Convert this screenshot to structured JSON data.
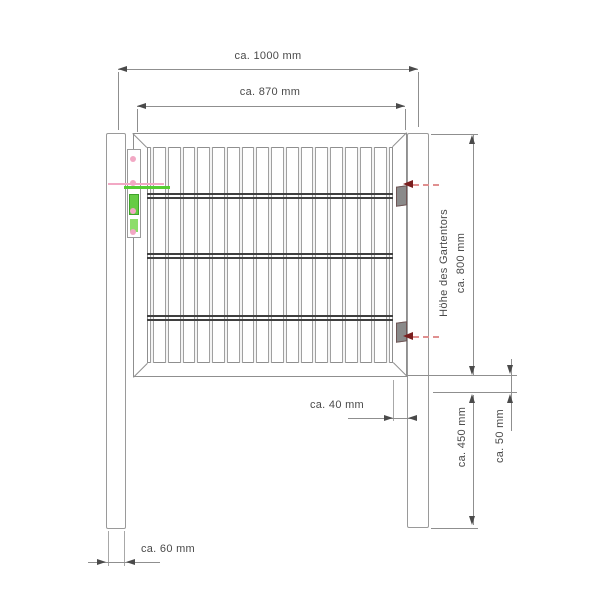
{
  "dimensions": {
    "total_width": "ca. 1000 mm",
    "gate_width": "ca. 870 mm",
    "gate_height_title": "Höhe des Gartentors",
    "gate_height_value": "ca. 800 mm",
    "frame_profile": "ca. 40 mm",
    "post_embed_depth": "ca. 450 mm",
    "ground_clearance": "ca. 50 mm",
    "post_width": "ca. 60 mm"
  },
  "colors": {
    "line": "#9a9a9a",
    "wire": "#3f3f3f",
    "dim_text": "#4a4a4a",
    "lock_highlight_green": "#55cc33",
    "screw_pink": "#f2a8c4",
    "hinge_arrow_red": "#7a1f1f",
    "hinge_arrow_red_light": "#e09090"
  },
  "structure": {
    "vertical_bars": 17,
    "horizontal_wire_rows": 3
  }
}
